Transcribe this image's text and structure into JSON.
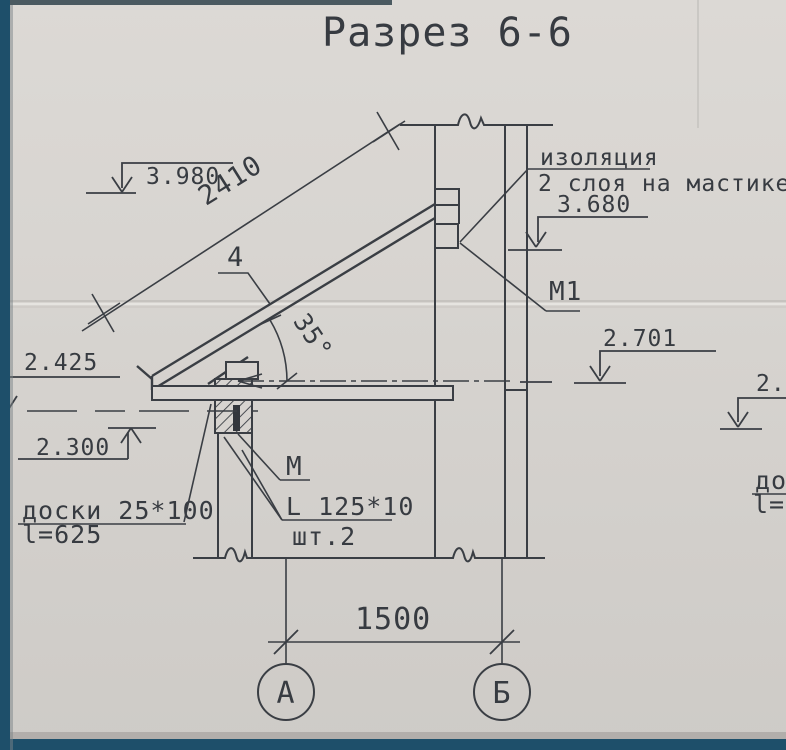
{
  "title": "Разрез 6-6",
  "colors": {
    "paper": "#d7d4d0",
    "ink": "#3a3e44",
    "scan_edge_blue": "#1e4f6a"
  },
  "labels": {
    "insulation_l1": "изоляция",
    "insulation_l2": "2 слоя на мастике",
    "elev_top_right": "3.680",
    "elev_top_left": "3.980",
    "elev_mid_right": "2.701",
    "elev_left_upper": "2.425",
    "elev_left_lower": "2.300",
    "elev_right_edge": "2.4",
    "rafter_length": "2410",
    "part_number": "4",
    "angle": "35°",
    "mark_m1": "М1",
    "mark_m": "М",
    "angle_steel": "L 125*10",
    "angle_steel_qty": "шт.2",
    "boards": "доски 25*100",
    "boards_length": "l=625",
    "right_edge_boards": "до",
    "right_edge_length": "l=6",
    "span": "1500",
    "axis_left": "А",
    "axis_right": "Б"
  }
}
